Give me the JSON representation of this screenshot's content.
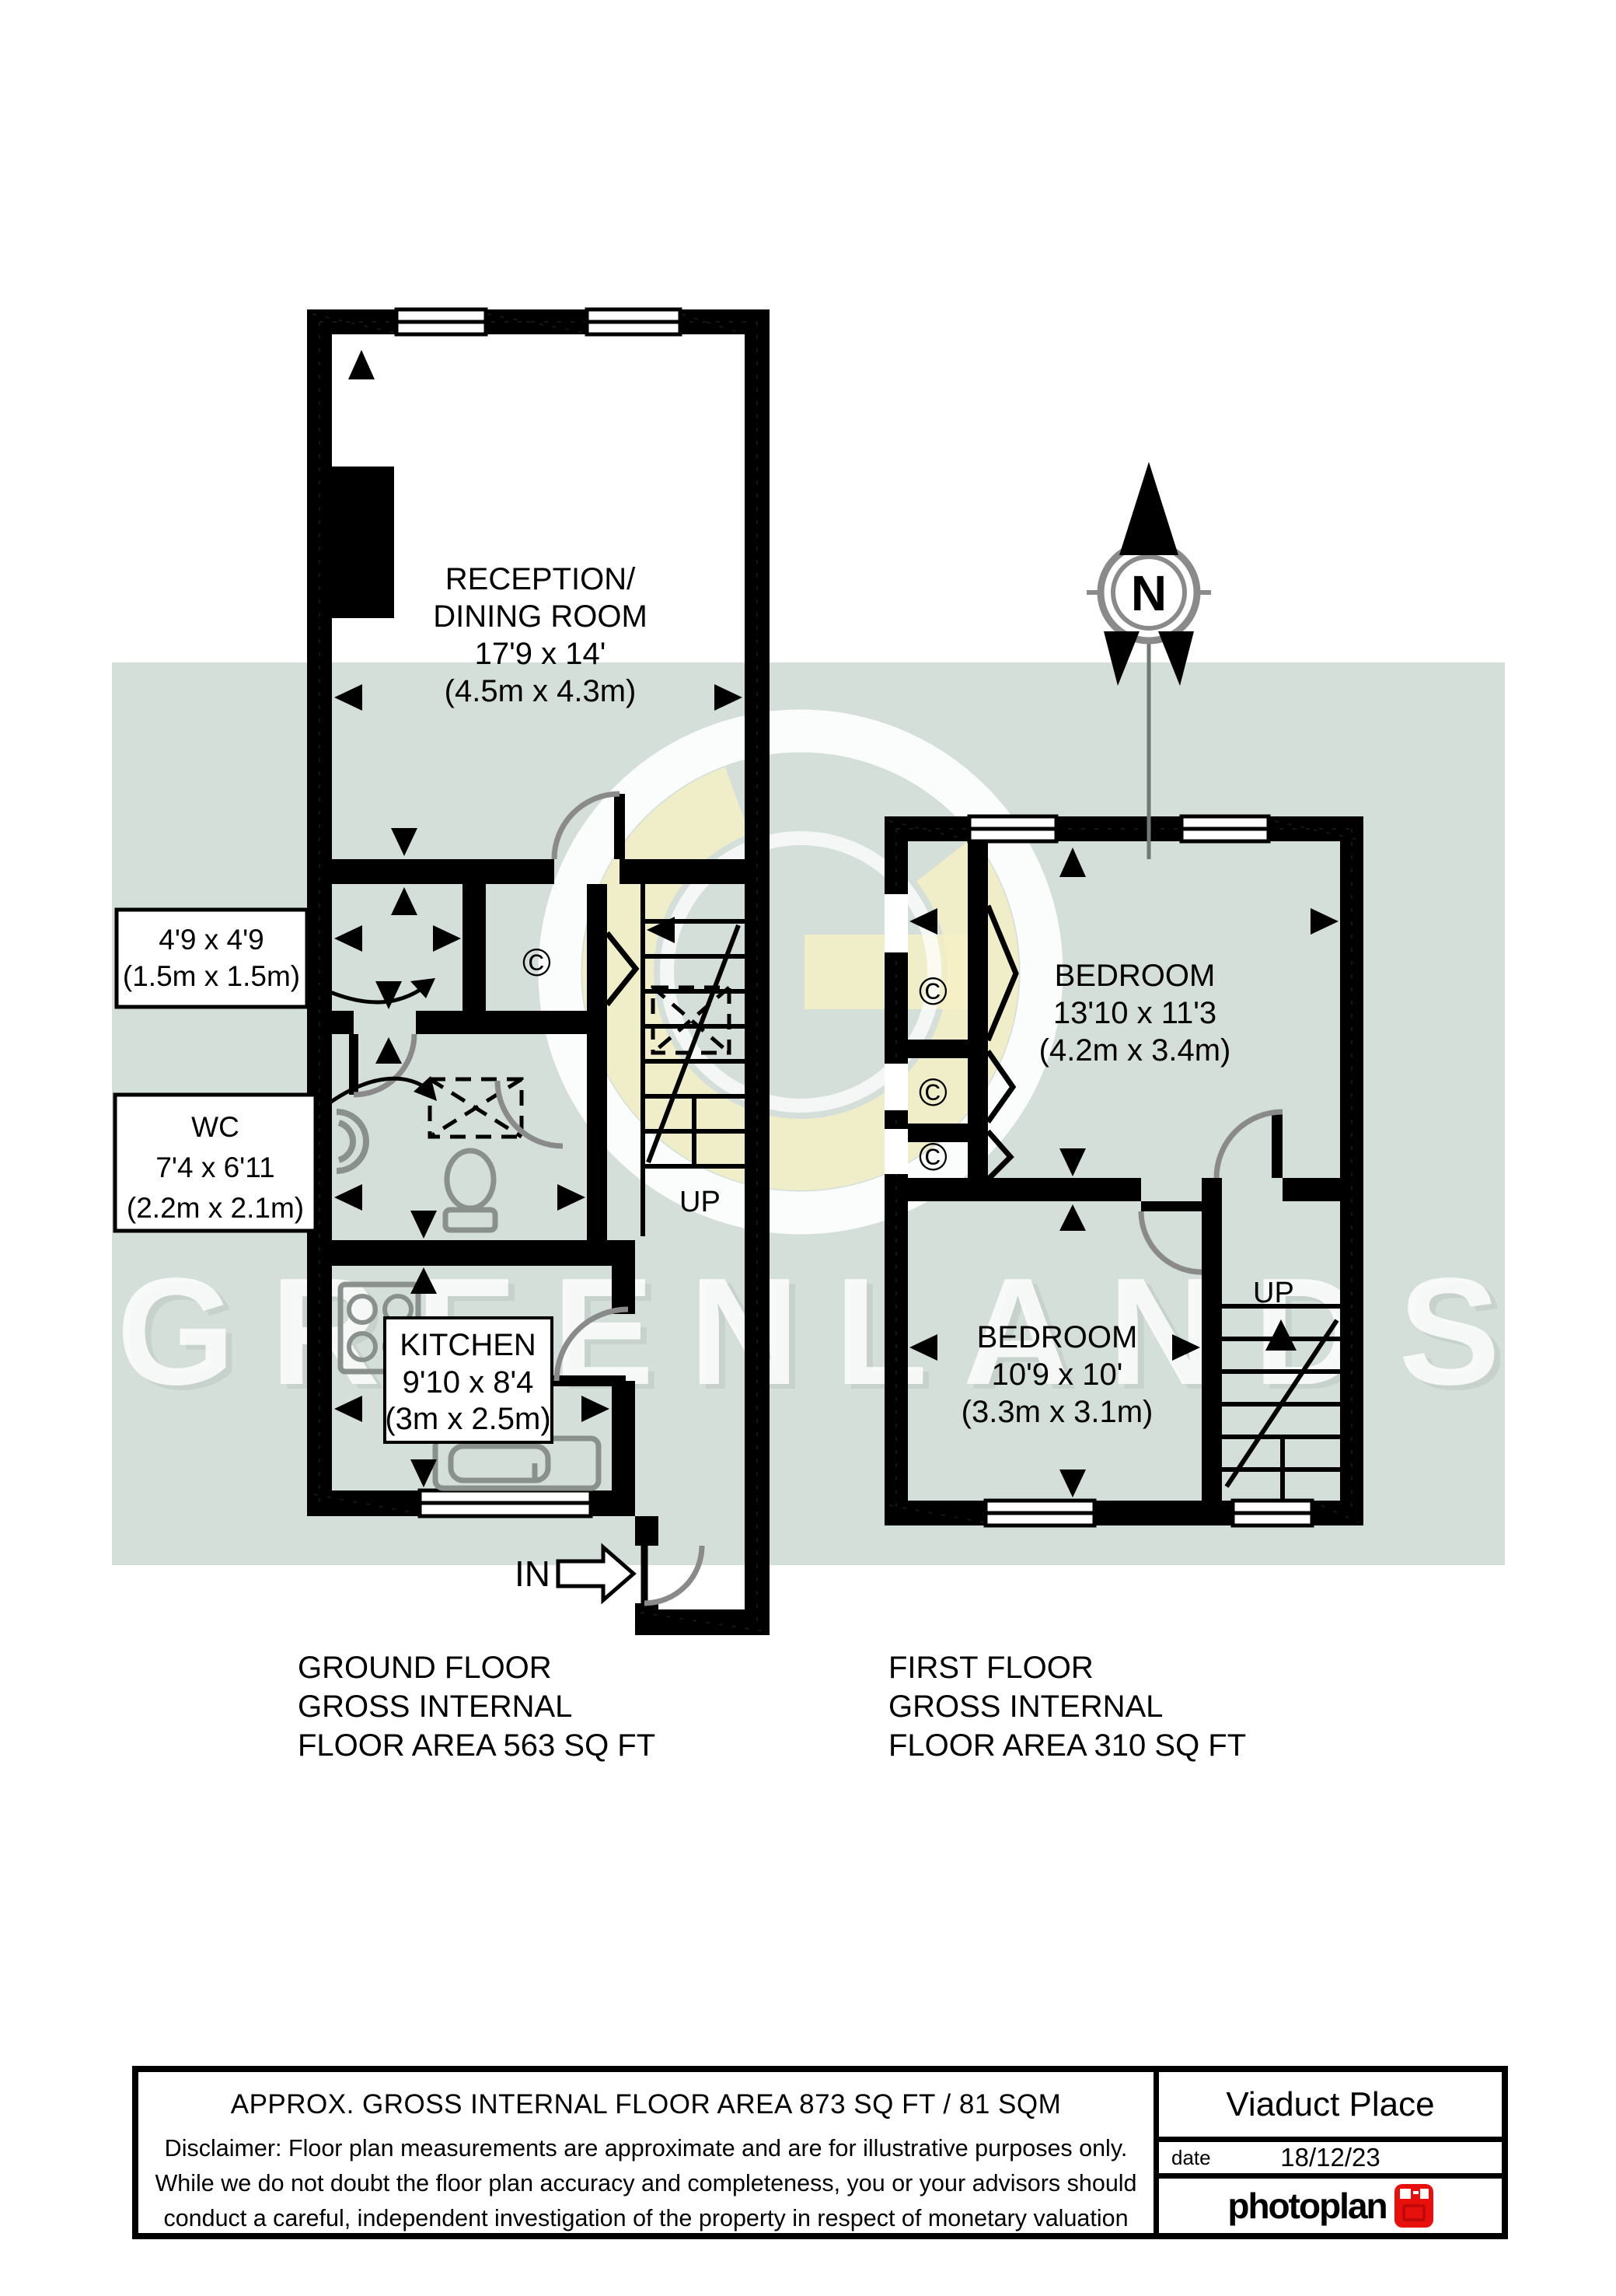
{
  "watermark": {
    "brand": "GREENLANDS"
  },
  "compass": {
    "label": "N"
  },
  "ground_floor": {
    "reception": {
      "line1": "RECEPTION/",
      "line2": "DINING ROOM",
      "dims": "17'9 x 14'",
      "metric": "(4.5m x 4.3m)"
    },
    "kitchen": {
      "name": "KITCHEN",
      "dims": "9'10 x 8'4",
      "metric": "(3m x 2.5m)"
    },
    "callout_small": {
      "line1": "4'9 x 4'9",
      "line2": "(1.5m x 1.5m)"
    },
    "callout_wc": {
      "line1": "WC",
      "line2": "7'4 x 6'11",
      "line3": "(2.2m x 2.1m)"
    },
    "stairs_label": "UP",
    "entrance_label": "IN",
    "closet_symbol": "©",
    "caption": {
      "line1": "GROUND FLOOR",
      "line2": "GROSS INTERNAL",
      "line3": "FLOOR AREA 563 SQ FT"
    }
  },
  "first_floor": {
    "bedroom1": {
      "name": "BEDROOM",
      "dims": "13'10 x 11'3",
      "metric": "(4.2m x 3.4m)"
    },
    "bedroom2": {
      "name": "BEDROOM",
      "dims": "10'9 x 10'",
      "metric": "(3.3m x 3.1m)"
    },
    "closet_symbol": "©",
    "stairs_label": "UP",
    "caption": {
      "line1": "FIRST FLOOR",
      "line2": "GROSS INTERNAL",
      "line3": "FLOOR AREA 310 SQ FT"
    }
  },
  "footer": {
    "area_summary": "APPROX. GROSS INTERNAL FLOOR AREA 873 SQ FT / 81 SQM",
    "disclaimer_line1": "Disclaimer: Floor plan measurements are approximate and are for illustrative purposes only.",
    "disclaimer_line2": "While we do not doubt the floor plan accuracy and completeness, you or your advisors should",
    "disclaimer_line3": "conduct a careful, independent investigation of the property in respect of monetary valuation",
    "property_name": "Viaduct Place",
    "date_label": "date",
    "date_value": "18/12/23",
    "logo_text": "photoplan"
  },
  "colors": {
    "band": "#d4dfd9",
    "wall": "#000000",
    "fixture": "#8a918d",
    "door_arc": "#8a8a8a",
    "logo_red": "#e8100d",
    "watermark_yellow": "#f6f0c4"
  }
}
